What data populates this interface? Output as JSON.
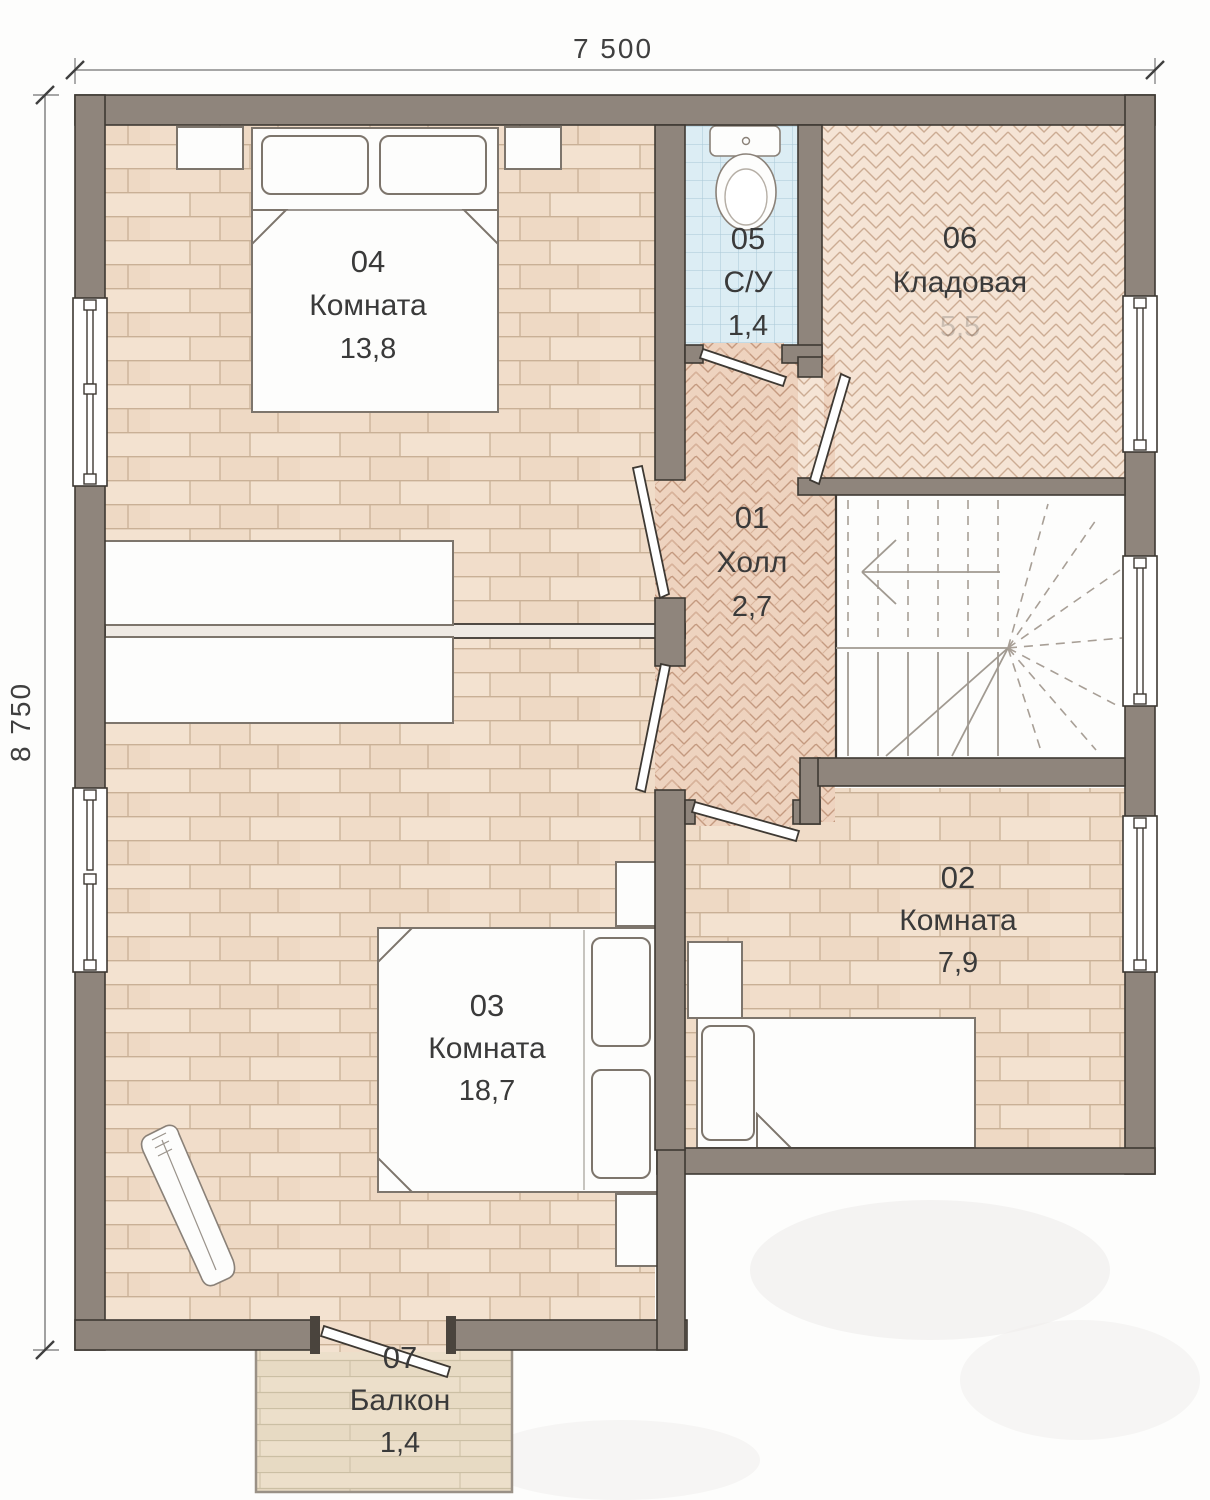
{
  "title": "Floor plan, second floor",
  "dimensions": {
    "width": "7 500",
    "height": "8 750"
  },
  "rooms": [
    {
      "number": "01",
      "name": "Холл",
      "area": "2,7"
    },
    {
      "number": "02",
      "name": "Комната",
      "area": "7,9"
    },
    {
      "number": "03",
      "name": "Комната",
      "area": "18,7"
    },
    {
      "number": "04",
      "name": "Комната",
      "area": "13,8"
    },
    {
      "number": "05",
      "name": "С/У",
      "area": "1,4"
    },
    {
      "number": "06",
      "name": "Кладовая",
      "area": "5,5"
    },
    {
      "number": "07",
      "name": "Балкон",
      "area": "1,4"
    }
  ],
  "colors": {
    "wall": "#8f857c",
    "wall_outline": "#3e3933",
    "wood_floor": "#f1dfcc",
    "wood_joint": "#c9b096",
    "hall_herringbone": "#eed3bf",
    "hall_herringbone_line": "#c49a80",
    "storage_herringbone": "#f5e4d5",
    "storage_herringbone_line": "#ccac93",
    "bath_tile": "#dcedf4",
    "bath_tile_line": "#a9c8d6",
    "balcony_deck": "#eadfc8",
    "balcony_deck_line": "#cbbfa4",
    "label_text": "#3a3a3a"
  }
}
